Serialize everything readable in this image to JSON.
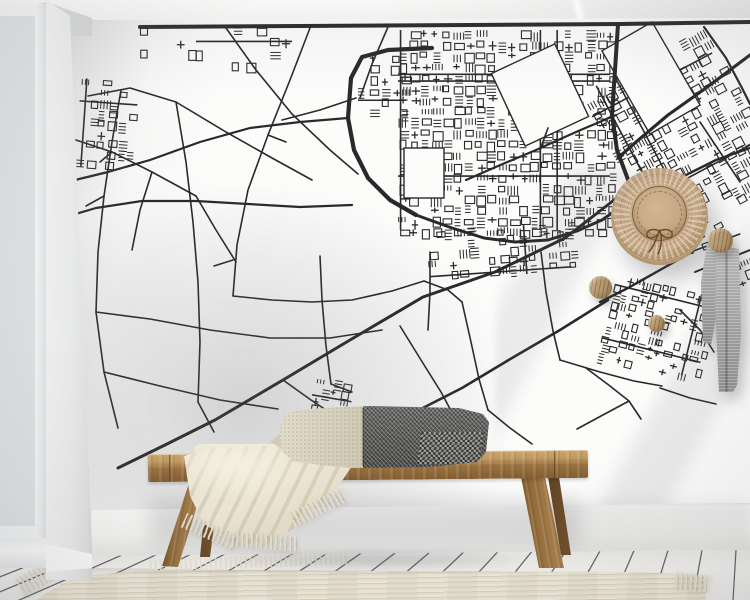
{
  "palette": {
    "map_ink": "#1a1a1a",
    "wall_white": "#fcfcfb",
    "ceiling": "#f1f1f0",
    "baseboard": "#f8f8f7",
    "floor_light": "#f1f0ed",
    "floor_seam": "#3c3f42",
    "rug_cream": "#e9e3d3",
    "bench_wood_light": "#c09962",
    "bench_wood_dark": "#845d31",
    "blanket_cream": "#ece6d5",
    "pillow_cream": "#d9d2c1",
    "pillow_gray": "#565655",
    "hat_straw": "#c8aa88",
    "hat_line": "#6d4e2b",
    "knob_wood": "#b3966f",
    "scarf_gray": "#a3a3a3",
    "window_frame": "#f1f3f4"
  },
  "objects": {
    "window": {
      "pane_rows": 7,
      "pane_cols": 2
    },
    "wall_hooks": 3,
    "accessories": [
      "straw-hat",
      "gray-scarf"
    ],
    "furniture": [
      "wooden-bench",
      "lumbar-pillow",
      "throw-blanket",
      "ribbed-rug"
    ]
  },
  "map": {
    "stroke": "#1a1a1a",
    "major_roads": [
      {
        "w": 4.0,
        "pts": [
          [
            140,
            27
          ],
          [
            300,
            26
          ],
          [
            470,
            25
          ],
          [
            620,
            24
          ],
          [
            750,
            22
          ]
        ]
      },
      {
        "w": 4.0,
        "pts": [
          [
            618,
            24
          ],
          [
            615,
            70
          ],
          [
            612,
            115
          ],
          [
            617,
            150
          ],
          [
            630,
            185
          ],
          [
            650,
            215
          ],
          [
            670,
            237
          ],
          [
            692,
            252
          ]
        ]
      },
      {
        "w": 3.2,
        "pts": [
          [
            750,
            55
          ],
          [
            706,
            88
          ],
          [
            668,
            115
          ],
          [
            636,
            142
          ],
          [
            618,
            158
          ]
        ]
      },
      {
        "w": 4.2,
        "pts": [
          [
            432,
            48
          ],
          [
            388,
            50
          ],
          [
            362,
            57
          ],
          [
            351,
            78
          ],
          [
            348,
            118
          ],
          [
            354,
            150
          ],
          [
            368,
            178
          ],
          [
            390,
            200
          ],
          [
            416,
            215
          ]
        ]
      },
      {
        "w": 3.0,
        "pts": [
          [
            416,
            215
          ],
          [
            452,
            228
          ],
          [
            484,
            238
          ],
          [
            515,
            242
          ],
          [
            548,
            240
          ],
          [
            577,
            231
          ],
          [
            602,
            220
          ],
          [
            622,
            206
          ],
          [
            634,
            190
          ]
        ]
      },
      {
        "w": 3.0,
        "pts": [
          [
            627,
            190
          ],
          [
            565,
            238
          ],
          [
            495,
            272
          ],
          [
            423,
            297
          ],
          [
            350,
            340
          ],
          [
            283,
            380
          ],
          [
            215,
            420
          ],
          [
            165,
            445
          ],
          [
            118,
            468
          ]
        ]
      },
      {
        "w": 2.4,
        "pts": [
          [
            692,
            252
          ],
          [
            660,
            270
          ],
          [
            628,
            288
          ],
          [
            600,
            302
          ]
        ]
      },
      {
        "w": 2.2,
        "pts": [
          [
            348,
            118
          ],
          [
            300,
            122
          ],
          [
            250,
            128
          ],
          [
            200,
            142
          ],
          [
            150,
            160
          ],
          [
            108,
            172
          ],
          [
            75,
            180
          ]
        ]
      },
      {
        "w": 2.2,
        "pts": [
          [
            352,
            205
          ],
          [
            300,
            207
          ],
          [
            248,
            204
          ],
          [
            196,
            201
          ],
          [
            142,
            201
          ],
          [
            96,
            208
          ],
          [
            72,
            215
          ]
        ]
      },
      {
        "w": 2.6,
        "pts": [
          [
            608,
            300
          ],
          [
            560,
            330
          ],
          [
            512,
            358
          ],
          [
            462,
            388
          ],
          [
            415,
            412
          ],
          [
            370,
            436
          ],
          [
            330,
            456
          ]
        ]
      },
      {
        "w": 2.2,
        "pts": [
          [
            616,
            115
          ],
          [
            576,
            132
          ],
          [
            536,
            150
          ],
          [
            498,
            166
          ],
          [
            466,
            180
          ]
        ]
      },
      {
        "w": 2.4,
        "pts": [
          [
            750,
            148
          ],
          [
            716,
            160
          ],
          [
            688,
            174
          ],
          [
            664,
            188
          ]
        ]
      },
      {
        "w": 2.0,
        "pts": [
          [
            750,
            250
          ],
          [
            720,
            262
          ],
          [
            695,
            272
          ]
        ]
      },
      {
        "w": 2.2,
        "pts": [
          [
            704,
            27
          ],
          [
            726,
            58
          ],
          [
            742,
            88
          ],
          [
            750,
            104
          ]
        ]
      }
    ],
    "minor_roads": [
      [
        [
          88,
          96
        ],
        [
          130,
          88
        ],
        [
          176,
          102
        ],
        [
          226,
          132
        ],
        [
          272,
          158
        ],
        [
          312,
          180
        ]
      ],
      [
        [
          76,
          140
        ],
        [
          112,
          152
        ],
        [
          152,
          172
        ],
        [
          196,
          196
        ]
      ],
      [
        [
          121,
          90
        ],
        [
          112,
          142
        ],
        [
          104,
          196
        ],
        [
          98,
          252
        ],
        [
          96,
          312
        ],
        [
          104,
          372
        ],
        [
          118,
          428
        ]
      ],
      [
        [
          176,
          102
        ],
        [
          186,
          162
        ],
        [
          193,
          222
        ],
        [
          198,
          282
        ],
        [
          200,
          342
        ],
        [
          198,
          402
        ]
      ],
      [
        [
          310,
          28
        ],
        [
          290,
          80
        ],
        [
          268,
          135
        ],
        [
          248,
          190
        ],
        [
          237,
          245
        ],
        [
          233,
          296
        ]
      ],
      [
        [
          226,
          28
        ],
        [
          256,
          70
        ],
        [
          292,
          114
        ],
        [
          330,
          150
        ],
        [
          358,
          174
        ]
      ],
      [
        [
          388,
          27
        ],
        [
          372,
          64
        ],
        [
          360,
          98
        ]
      ],
      [
        [
          96,
          312
        ],
        [
          150,
          319
        ],
        [
          210,
          330
        ],
        [
          270,
          338
        ],
        [
          330,
          338
        ],
        [
          382,
          330
        ]
      ],
      [
        [
          104,
          372
        ],
        [
          160,
          386
        ],
        [
          220,
          400
        ],
        [
          278,
          409
        ]
      ],
      [
        [
          320,
          256
        ],
        [
          322,
          300
        ],
        [
          326,
          346
        ],
        [
          331,
          384
        ]
      ],
      [
        [
          233,
          296
        ],
        [
          272,
          300
        ],
        [
          312,
          302
        ],
        [
          352,
          300
        ],
        [
          392,
          291
        ],
        [
          424,
          281
        ]
      ],
      [
        [
          430,
          252
        ],
        [
          430,
          292
        ],
        [
          428,
          330
        ]
      ],
      [
        [
          462,
          302
        ],
        [
          471,
          342
        ],
        [
          479,
          379
        ],
        [
          488,
          410
        ]
      ],
      [
        [
          541,
          252
        ],
        [
          546,
          292
        ],
        [
          553,
          331
        ],
        [
          560,
          360
        ]
      ],
      [
        [
          560,
          360
        ],
        [
          600,
          372
        ],
        [
          634,
          381
        ],
        [
          662,
          386
        ]
      ],
      [
        [
          400,
          326
        ],
        [
          421,
          360
        ],
        [
          441,
          392
        ],
        [
          456,
          420
        ]
      ],
      [
        [
          283,
          380
        ],
        [
          311,
          400
        ],
        [
          341,
          420
        ],
        [
          372,
          440
        ]
      ],
      [
        [
          80,
          330
        ],
        [
          75,
          380
        ],
        [
          78,
          432
        ],
        [
          88,
          470
        ]
      ],
      [
        [
          586,
          368
        ],
        [
          610,
          386
        ],
        [
          629,
          401
        ],
        [
          641,
          419
        ]
      ],
      [
        [
          629,
          401
        ],
        [
          601,
          416
        ],
        [
          577,
          429
        ]
      ],
      [
        [
          660,
          388
        ],
        [
          690,
          398
        ],
        [
          716,
          404
        ]
      ],
      [
        [
          700,
          122
        ],
        [
          720,
          152
        ],
        [
          740,
          182
        ]
      ],
      [
        [
          356,
          98
        ],
        [
          320,
          110
        ],
        [
          282,
          120
        ]
      ],
      [
        [
          152,
          172
        ],
        [
          140,
          210
        ],
        [
          132,
          250
        ]
      ],
      [
        [
          196,
          196
        ],
        [
          216,
          230
        ],
        [
          236,
          262
        ]
      ],
      [
        [
          424,
          281
        ],
        [
          448,
          290
        ],
        [
          462,
          302
        ]
      ],
      [
        [
          488,
          410
        ],
        [
          510,
          428
        ],
        [
          532,
          444
        ]
      ],
      [
        [
          198,
          402
        ],
        [
          214,
          432
        ]
      ],
      [
        [
          680,
          310
        ],
        [
          700,
          330
        ],
        [
          714,
          352
        ]
      ],
      [
        [
          540,
          150
        ],
        [
          548,
          128
        ]
      ],
      [
        [
          268,
          135
        ],
        [
          286,
          142
        ]
      ],
      [
        [
          112,
          152
        ],
        [
          100,
          162
        ]
      ],
      [
        [
          233,
          260
        ],
        [
          214,
          266
        ]
      ],
      [
        [
          331,
          384
        ],
        [
          352,
          392
        ]
      ],
      [
        [
          104,
          196
        ],
        [
          86,
          206
        ]
      ]
    ],
    "urban_regions": [
      {
        "x": 398,
        "y": 30,
        "w": 212,
        "h": 200,
        "cell": 11,
        "density": 0.82,
        "angle": 0,
        "seed": 3,
        "streets": 6
      },
      {
        "x": 614,
        "y": 52,
        "w": 136,
        "h": 178,
        "cell": 11,
        "density": 0.72,
        "angle": -28,
        "seed": 9,
        "streets": 4
      },
      {
        "x": 428,
        "y": 226,
        "w": 142,
        "h": 50,
        "cell": 10,
        "density": 0.5,
        "angle": -4,
        "seed": 5,
        "streets": 2
      },
      {
        "x": 606,
        "y": 284,
        "w": 102,
        "h": 84,
        "cell": 9,
        "density": 0.55,
        "angle": 14,
        "seed": 11,
        "streets": 3
      },
      {
        "x": 78,
        "y": 80,
        "w": 58,
        "h": 88,
        "cell": 10,
        "density": 0.5,
        "angle": 4,
        "seed": 13,
        "streets": 2
      },
      {
        "x": 358,
        "y": 54,
        "w": 48,
        "h": 66,
        "cell": 11,
        "density": 0.45,
        "angle": 0,
        "seed": 17,
        "streets": 1
      },
      {
        "x": 312,
        "y": 380,
        "w": 40,
        "h": 34,
        "cell": 9,
        "density": 0.5,
        "angle": 10,
        "seed": 19,
        "streets": 1
      },
      {
        "x": 196,
        "y": 26,
        "w": 96,
        "h": 38,
        "cell": 12,
        "density": 0.3,
        "angle": 0,
        "seed": 23,
        "streets": 1
      },
      {
        "x": 700,
        "y": 236,
        "w": 50,
        "h": 58,
        "cell": 10,
        "density": 0.38,
        "angle": -20,
        "seed": 29,
        "streets": 1
      },
      {
        "x": 140,
        "y": 26,
        "w": 56,
        "h": 30,
        "cell": 12,
        "density": 0.25,
        "angle": 0,
        "seed": 31,
        "streets": 0
      }
    ],
    "clear_patches": [
      {
        "x": 505,
        "y": 55,
        "w": 70,
        "h": 80,
        "angle": -25
      },
      {
        "x": 622,
        "y": 30,
        "w": 58,
        "h": 96,
        "angle": -30
      },
      {
        "x": 404,
        "y": 148,
        "w": 40,
        "h": 50,
        "angle": 0
      }
    ]
  },
  "floor": {
    "vp": [
      752,
      279
    ],
    "wall_y": 555,
    "wall_slope": 0.007,
    "bottom_y": 604,
    "seam_start_x": -12,
    "seam_spacing": 34,
    "seam_count": 24,
    "seam_color": "#3c3f42"
  }
}
